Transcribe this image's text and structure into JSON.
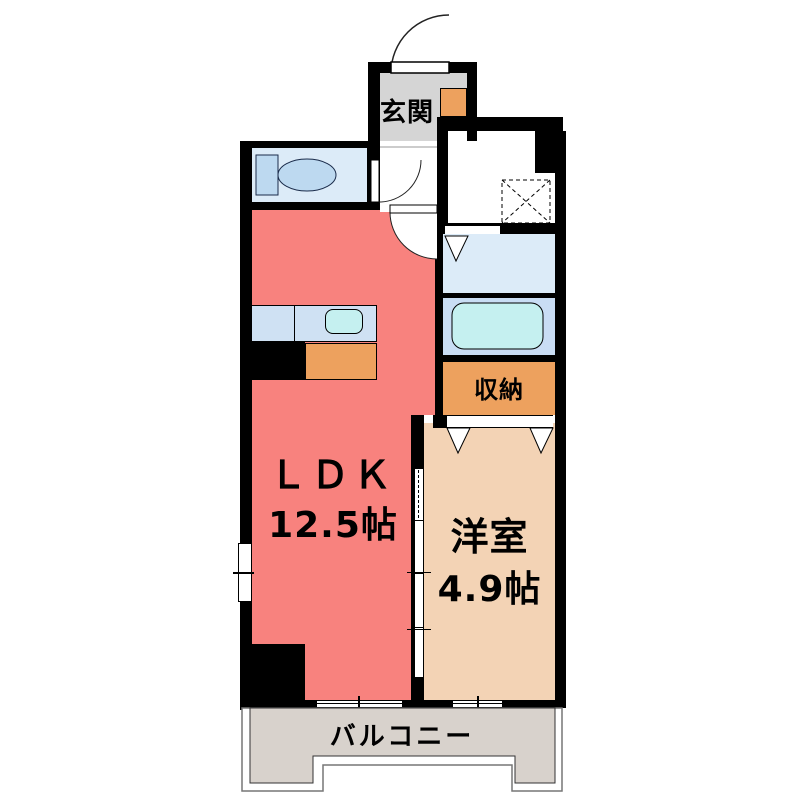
{
  "floorplan": {
    "rooms": {
      "genkan": {
        "label": "玄関"
      },
      "ldk": {
        "label": "ＬＤＫ",
        "size": "12.5帖"
      },
      "youshitsu": {
        "label": "洋室",
        "size": "4.9帖"
      },
      "shuunou": {
        "label": "収納"
      },
      "balcony": {
        "label": "バルコニー"
      }
    },
    "colors": {
      "wall": "#000000",
      "ldk_floor": "#f8827e",
      "western_room_floor": "#f3d3b5",
      "storage_orange": "#eda15e",
      "wet_area_floor": "#dcebf8",
      "bath_floor": "#c9ddf4",
      "tub_and_sink": "#c5f0f0",
      "kitchen_counter": "#cfe1f3",
      "genkan_floor": "#d5d5d5",
      "balcony_floor": "#d8d2cc"
    }
  }
}
